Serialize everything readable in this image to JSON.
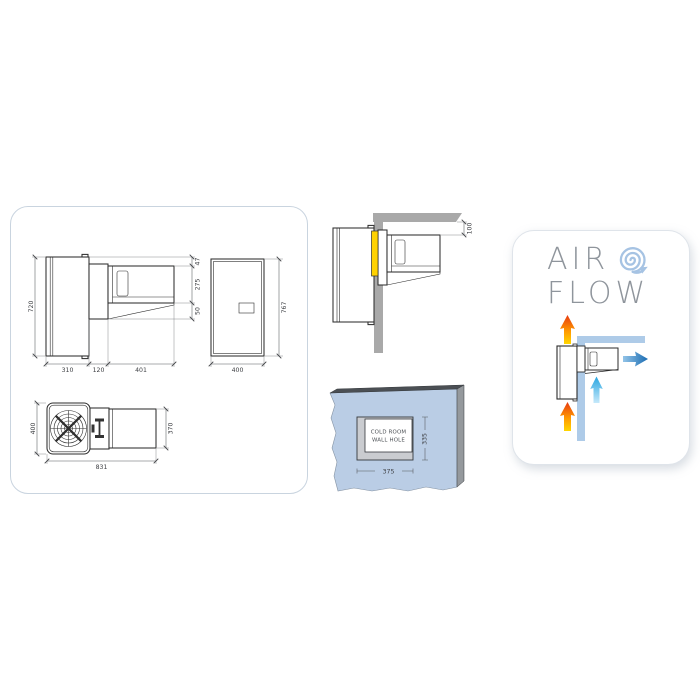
{
  "dimension_panel": {
    "side_view": {
      "height": "720",
      "top_gap": "47",
      "indoor_height": "275",
      "bottom_lip": "50",
      "depth_condenser": "310",
      "depth_wall": "120",
      "depth_evaporator": "401"
    },
    "front_view": {
      "height": "767",
      "width": "400"
    },
    "top_view": {
      "width_condenser": "400",
      "width_evaporator": "370",
      "length_total": "831"
    }
  },
  "installation_view": {
    "ceiling_clearance": "100"
  },
  "wall_hole_view": {
    "label_line1": "COLD ROOM",
    "label_line2": "WALL HOLE",
    "hole_width": "375",
    "hole_height": "335"
  },
  "air_flow_card": {
    "title_line1": "AIR",
    "title_line2": "FLOW"
  },
  "colors": {
    "drawing_line": "#2e2e2e",
    "dimension_text": "#3f4145",
    "panel_border": "#c9d4df",
    "gasket_yellow": "#ffd200",
    "wall_gray": "#a9a9a9",
    "cold_room_wall_blue": "#bacde5",
    "flow_wall_blue": "#aecbe8",
    "title_gray": "#8f959c",
    "swirl_blue": "#a6c3e3",
    "hot_arrow_red": "#e63a12",
    "hot_arrow_yellow": "#ffd600",
    "cold_supply_blue": "#1a6cb2",
    "return_air_cyan": "#27a5e0"
  }
}
